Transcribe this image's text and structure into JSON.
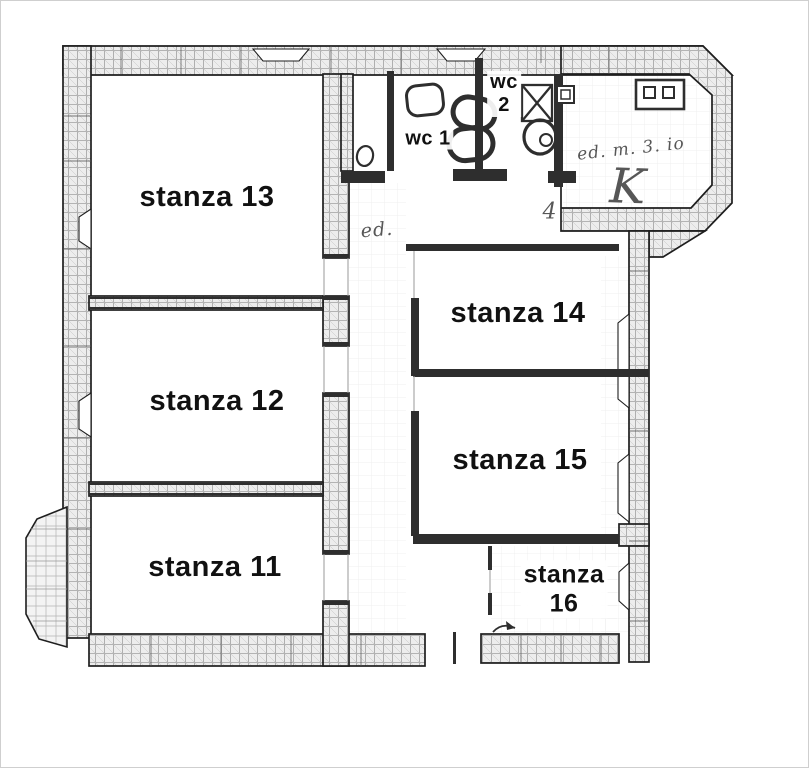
{
  "document": {
    "kind": "apartment floor plan (scanned blueprint)",
    "language": "Italian"
  },
  "rooms": [
    {
      "id": "stanza-13",
      "label": "stanza 13"
    },
    {
      "id": "stanza-12",
      "label": "stanza 12"
    },
    {
      "id": "stanza-11",
      "label": "stanza 11"
    },
    {
      "id": "stanza-14",
      "label": "stanza 14"
    },
    {
      "id": "stanza-15",
      "label": "stanza 15"
    },
    {
      "id": "stanza-16",
      "label_line1": "stanza",
      "label_line2": "16"
    },
    {
      "id": "wc-1",
      "label": "wc 1"
    },
    {
      "id": "wc-2",
      "label_line1": "wc",
      "label_line2": "2"
    }
  ],
  "annotations": [
    {
      "id": "entry-door-note",
      "label": "ed."
    },
    {
      "id": "kitchen-note",
      "label": "ed. m. 3. io"
    },
    {
      "id": "kitchen-letter",
      "label": "K"
    },
    {
      "id": "door-mark",
      "label": "4"
    }
  ],
  "colors": {
    "paper": "#ffffff",
    "ink": "#1e1e1e",
    "wall_fill": "#ededed",
    "hatch": "#a0a0a0",
    "text": "#111111",
    "hand": "#3a3a3a"
  }
}
